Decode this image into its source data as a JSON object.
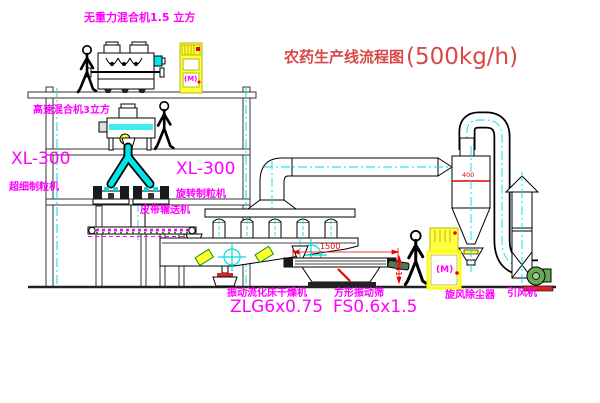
{
  "title": {
    "cn": "农药生产线流程图",
    "capacity": "(500kg/h)"
  },
  "labels": {
    "top_mixer": "无重力混合机1.5 立方",
    "highspeed_mixer": "高速混合机3立方",
    "granulator_left_model": "XL-300",
    "granulator_left_name": "超细制粒机",
    "granulator_right_model": "XL-300",
    "granulator_right_name": "旋转制粒机",
    "belt_conveyor": "皮带输送机",
    "dryer_name": "振动流化床干燥机",
    "dryer_model": "ZLG6x0.75",
    "sieve_name": "方形振动筛",
    "sieve_model": "FS0.6x1.5",
    "cyclone": "旋风除尘器",
    "fan": "引风机",
    "motor_symbol": "(M)"
  },
  "dimensions": {
    "sieve_width": "1500",
    "sieve_height": "541",
    "cyclone_dia": "400"
  },
  "colors": {
    "label_magenta": "#FF00FF",
    "title_red": "#D84848",
    "centerline_cyan": "#00DDDD",
    "cabinet_yellow": "#FFFF44",
    "dimension_red": "#EE0000",
    "fan_green": "#66AA55"
  }
}
